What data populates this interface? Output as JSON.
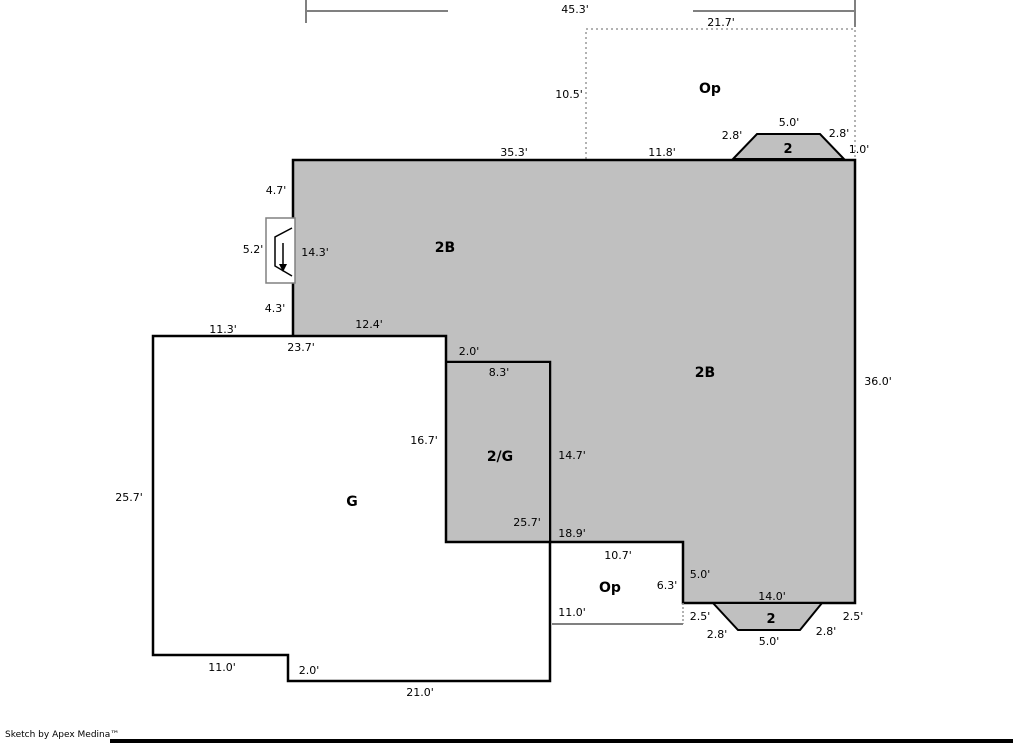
{
  "sketch": {
    "regions": {
      "main_upper": "2B",
      "main_right": "2B",
      "garage": "G",
      "garage_half": "2/G",
      "open_top": "Op",
      "open_bottom": "Op",
      "bay_window_top": "2",
      "bay_window_bottom": "2"
    },
    "dimensions": {
      "top_total": "45.3'",
      "open_top_width": "21.7'",
      "open_top_height": "10.5'",
      "top_wall_left": "35.3'",
      "top_wall_right": "11.8'",
      "bay_top_left_slant": "2.8'",
      "bay_top_width": "5.0'",
      "bay_top_right_slant": "2.8'",
      "top_right_corner": "1.0'",
      "left_upper": "4.7'",
      "fireplace_width": "5.2'",
      "left_total": "14.3'",
      "left_lower": "4.3'",
      "garage_top": "11.3'",
      "garage_top_total": "23.7'",
      "main_bottom_ledge": "12.4'",
      "step_down": "2.0'",
      "half_top": "8.3'",
      "half_left": "16.7'",
      "half_right": "14.7'",
      "half_bottom": "25.7'",
      "mid_bottom": "18.9'",
      "right_total": "36.0'",
      "garage_left": "25.7'",
      "garage_bottom_left": "11.0'",
      "garage_bottom_step": "2.0'",
      "garage_bottom": "21.0'",
      "open_bottom_top": "10.7'",
      "open_bottom_right_total": "6.3'",
      "open_bottom_right_wall": "5.0'",
      "open_bottom_width": "11.0'",
      "bottom_wall": "14.0'",
      "bay_bottom_left_corner": "2.5'",
      "bay_bottom_left_slant": "2.8'",
      "bay_bottom_width": "5.0'",
      "bay_bottom_right_slant": "2.8'",
      "bay_bottom_right_corner": "2.5'"
    },
    "footer": {
      "credit": "Sketch by Apex Medina™"
    },
    "colors": {
      "living_area_fill": "#c0c0c0",
      "wall_stroke": "#000000",
      "dimension_line": "#808080",
      "open_area_outline": "#999999"
    }
  }
}
